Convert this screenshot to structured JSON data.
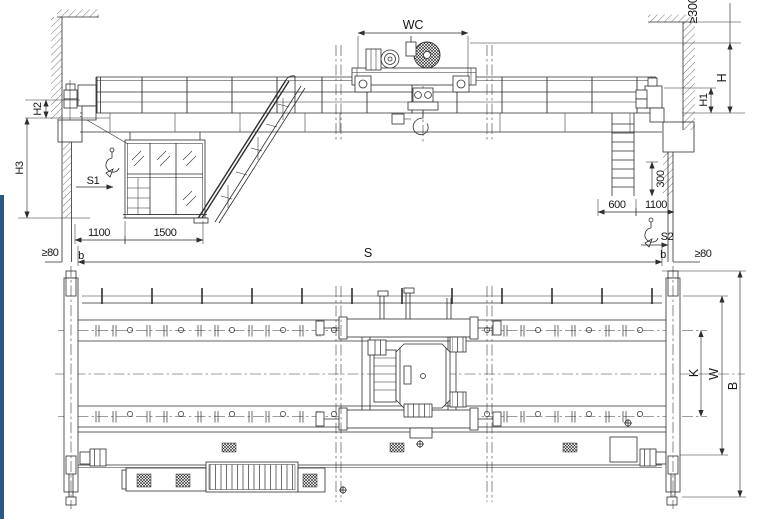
{
  "drawing": {
    "type": "overhead-bridge-crane-general-arrangement",
    "colors": {
      "line": "#2e2e2e",
      "background": "#ffffff",
      "accent_bar": "#2f567d"
    },
    "labels": {
      "elevation": {
        "trolley_gauge": "WC",
        "top_clearance": "≥300",
        "height_h": "H",
        "height_h1": "H1",
        "height_h2": "H2",
        "height_h3": "H3",
        "hook_approach_left": "S1",
        "hook_approach_right": "S2",
        "span": "S",
        "b_left": "b",
        "b_right": "b",
        "wall_clearance_left": "≥80",
        "wall_clearance_right": "≥80",
        "dim_1100_left": "1100",
        "dim_1500": "1500",
        "dim_600": "600",
        "dim_1100_right": "1100",
        "dim_300": "300"
      },
      "plan": {
        "rail_gauge": "K",
        "wheel_base": "W",
        "bridge_width": "B"
      }
    }
  }
}
